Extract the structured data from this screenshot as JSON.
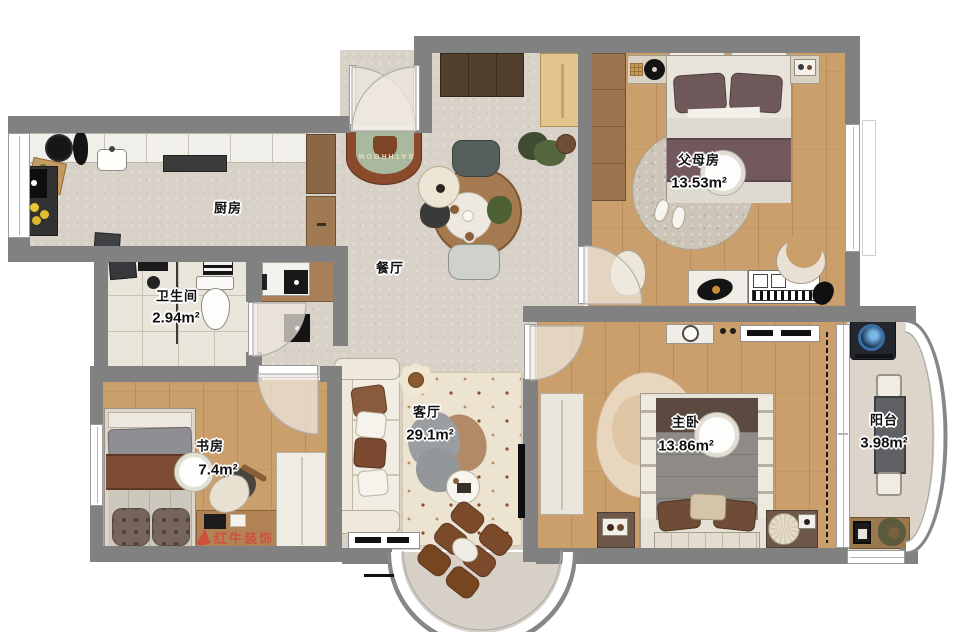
{
  "rooms": [
    {
      "id": "kitchen",
      "label": "厨房",
      "area": ""
    },
    {
      "id": "dining",
      "label": "餐厅",
      "area": ""
    },
    {
      "id": "parents",
      "label": "父母房",
      "area": "13.53m²"
    },
    {
      "id": "bathroom",
      "label": "卫生间",
      "area": "2.94m²"
    },
    {
      "id": "study",
      "label": "书房",
      "area": "7.4m²"
    },
    {
      "id": "living",
      "label": "客厅",
      "area": "29.1m²"
    },
    {
      "id": "master",
      "label": "主卧",
      "area": "13.86m²"
    },
    {
      "id": "balcony",
      "label": "阳台",
      "area": "3.98m²"
    }
  ],
  "decor": {
    "bath_rug_text": "BATHROOM"
  },
  "watermark": {
    "brand": "红牛装饰"
  },
  "colors": {
    "wall": "#818181",
    "floor_grey": "#d8d1c7",
    "floor_wood": "#cb9f6b",
    "bath_tile": "#eae5da",
    "accent_red": "#d6453a"
  }
}
